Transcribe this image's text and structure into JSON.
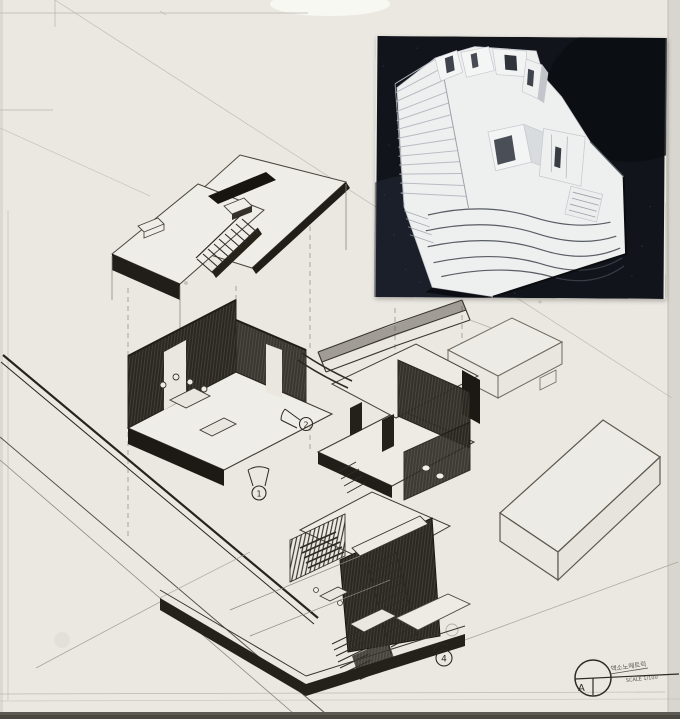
{
  "title_block": {
    "section_letter": "A",
    "annotation_line1": "액소노메트릭",
    "annotation_line2": "SCALE 1/100"
  },
  "view_markers": {
    "marker_top": "2",
    "marker_middle": "1",
    "marker_bottom": "4"
  },
  "colors": {
    "paper": "#ebe8e2",
    "pencil_dark": "#26231d",
    "photo_background": "#11141b",
    "model_white": "#eef0f0",
    "table_edge": "#4a4741"
  }
}
